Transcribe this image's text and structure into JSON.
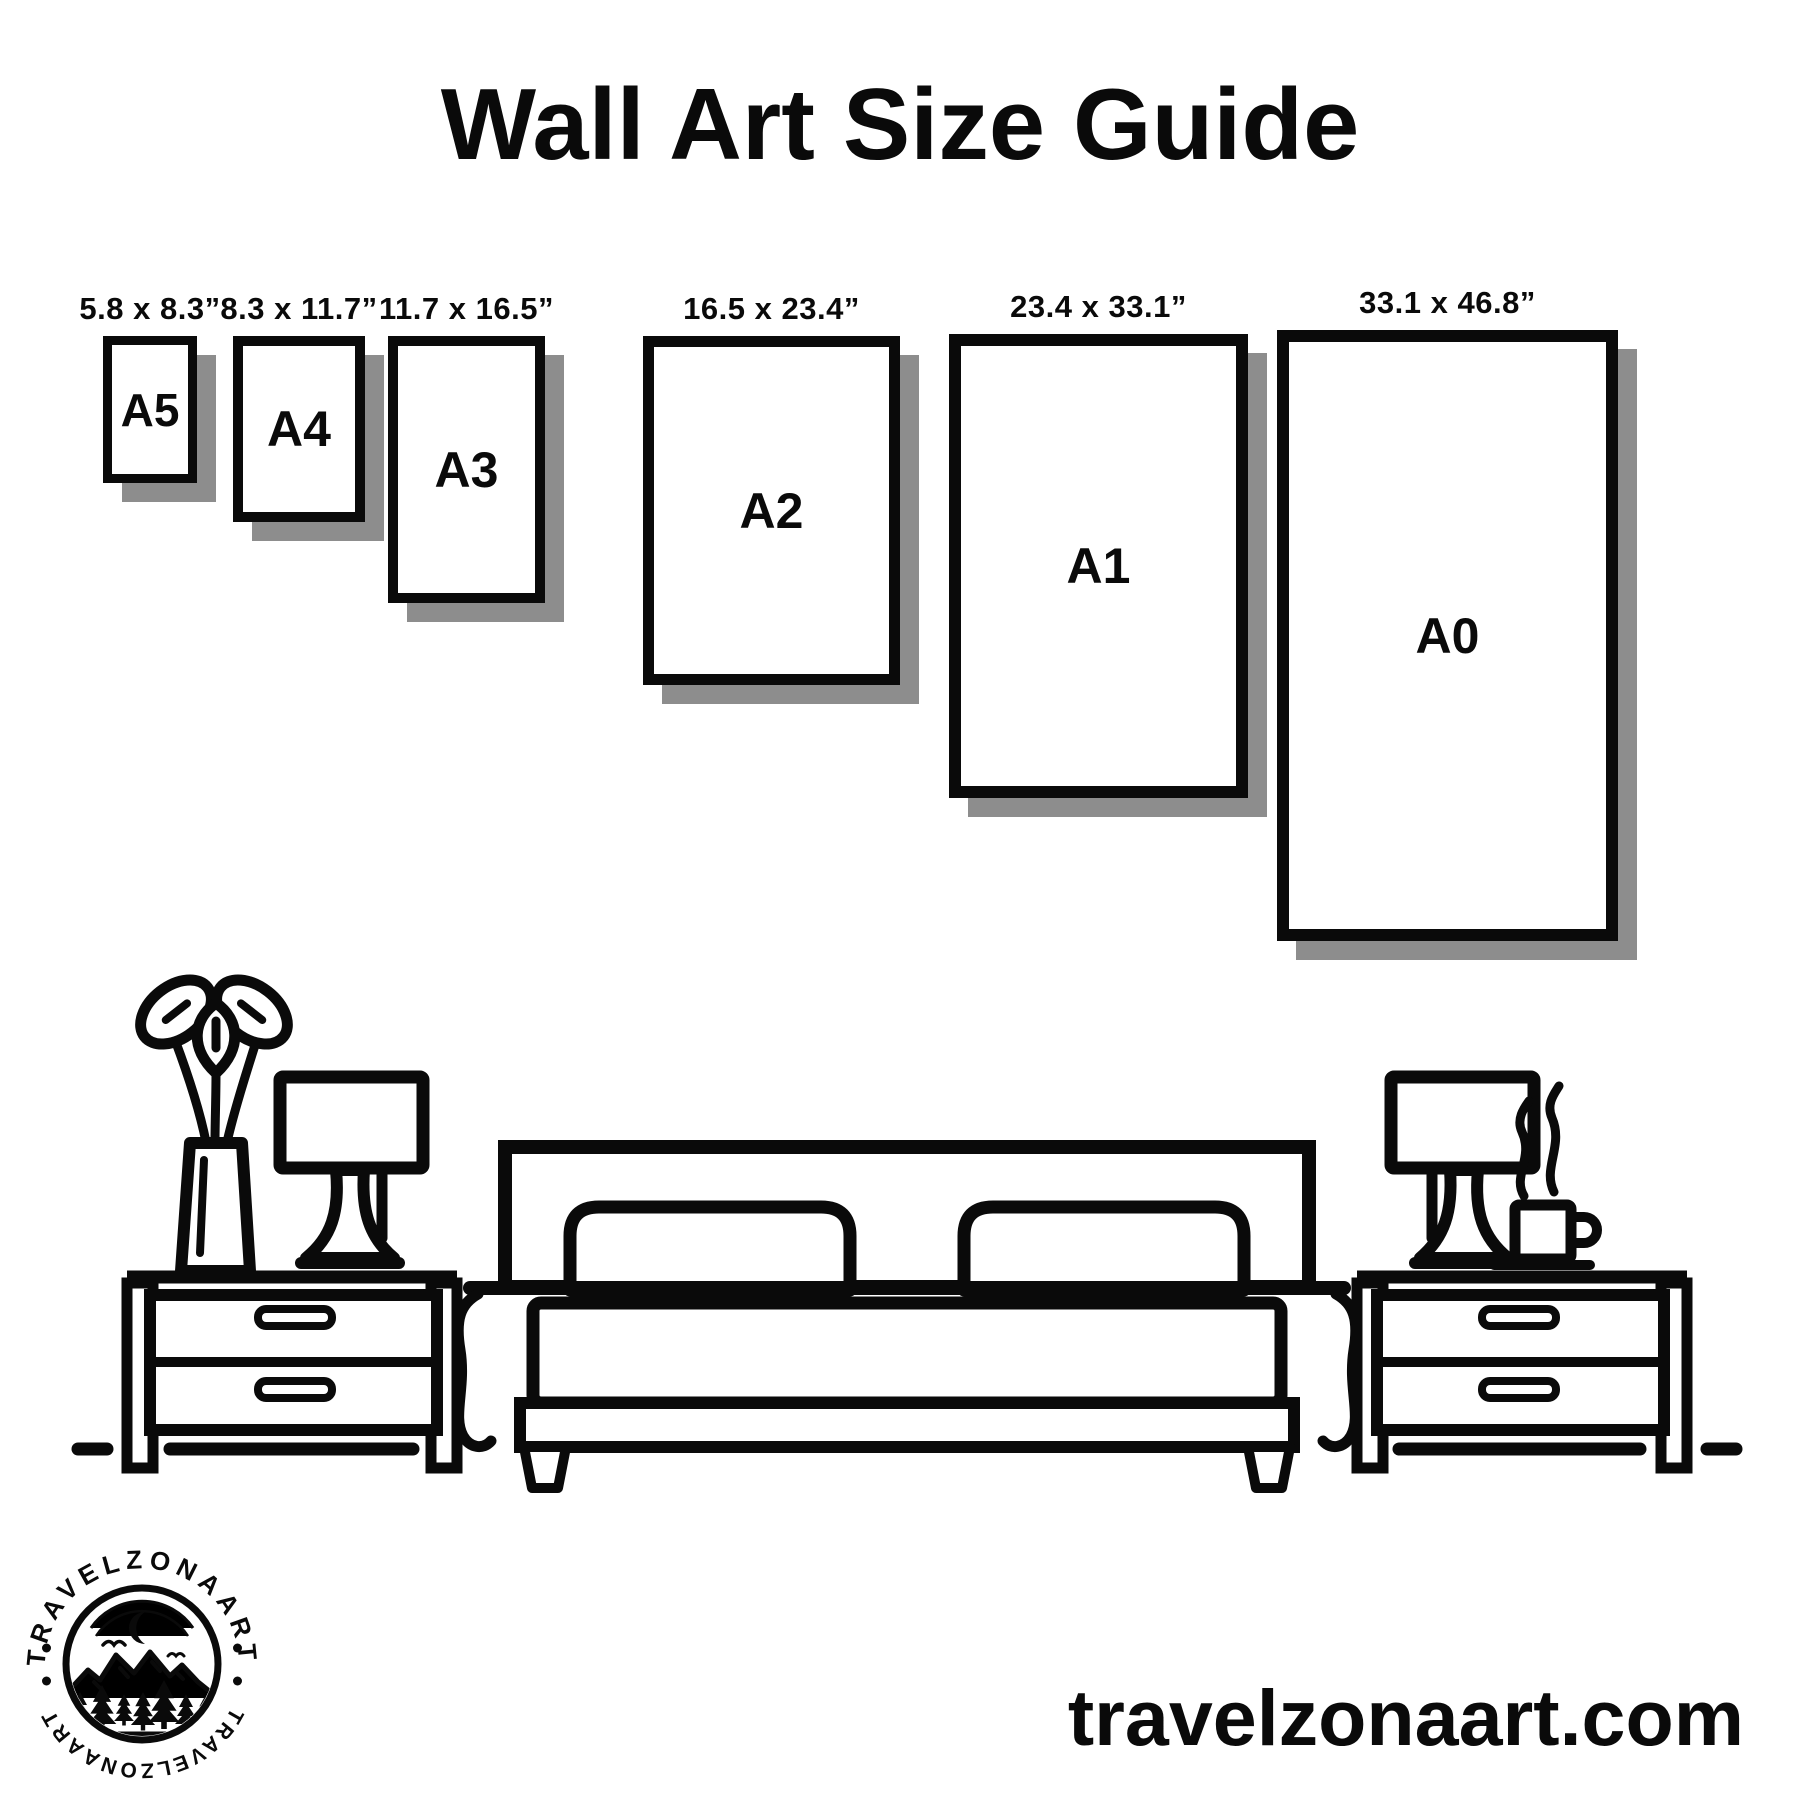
{
  "page": {
    "title": "Wall Art Size Guide"
  },
  "frames": [
    {
      "id": "a5",
      "name_label": "A5",
      "dims_label": "5.8 x 8.3”"
    },
    {
      "id": "a4",
      "name_label": "A4",
      "dims_label": "8.3 x 11.7”"
    },
    {
      "id": "a3",
      "name_label": "A3",
      "dims_label": "11.7 x 16.5”"
    },
    {
      "id": "a2",
      "name_label": "A2",
      "dims_label": "16.5 x 23.4”"
    },
    {
      "id": "a1",
      "name_label": "A1",
      "dims_label": "23.4 x 33.1”"
    },
    {
      "id": "a0",
      "name_label": "A0",
      "dims_label": "33.1 x 46.8”"
    }
  ],
  "footer": {
    "website": "travelzonaart.com"
  },
  "logo": {
    "brand_top": "TRAVELZONAART",
    "brand_bottom": "TRAVELZONAART"
  },
  "colors": {
    "ink": "#0a0a0a",
    "shadow": "#8d8d8d",
    "background": "#ffffff"
  },
  "illustration": {
    "items": [
      "flower-vase-icon",
      "table-lamp-icon",
      "nightstand-icon",
      "bed-icon",
      "coffee-cup-icon",
      "floor-line"
    ]
  }
}
